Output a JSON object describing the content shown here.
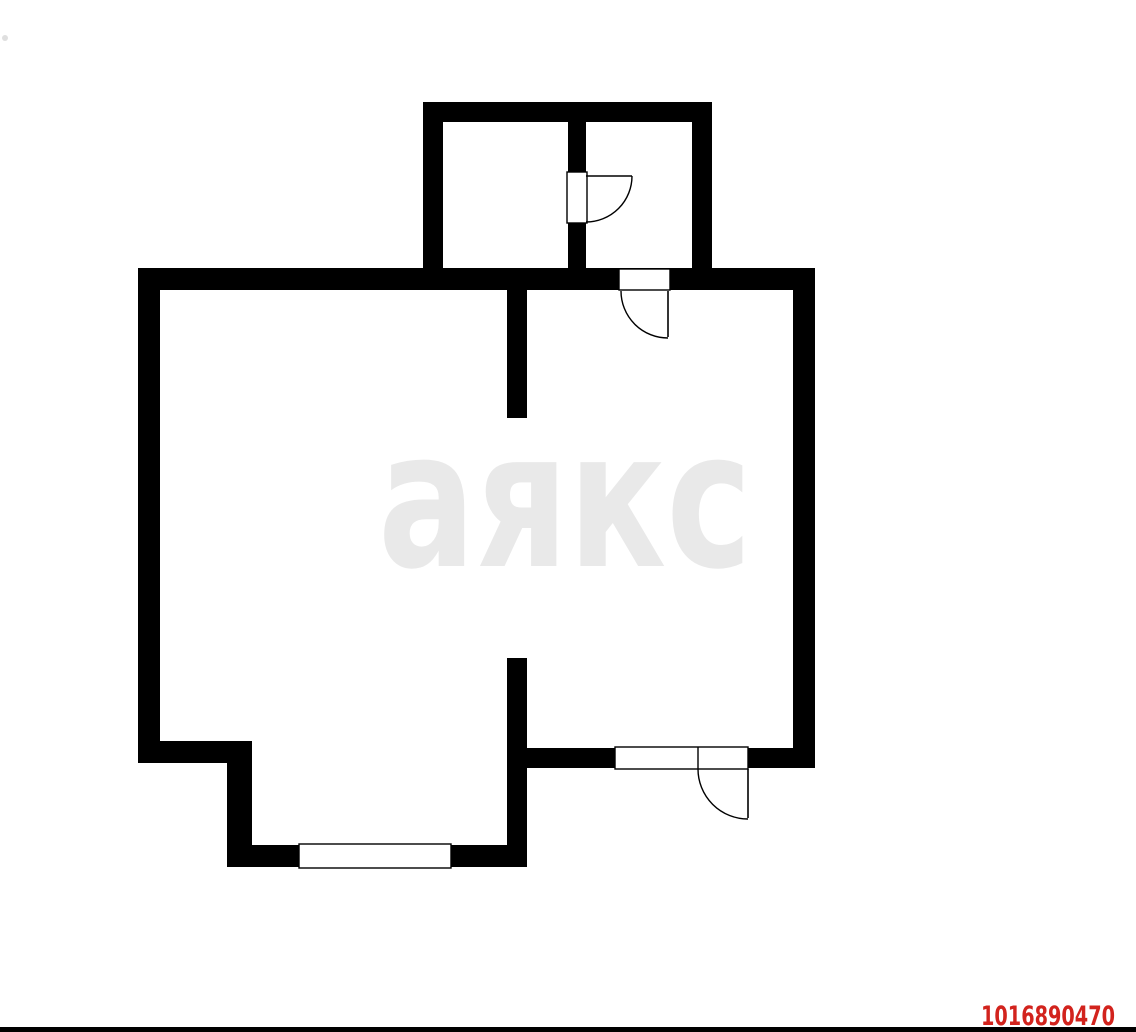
{
  "watermark": {
    "text": "аякс",
    "color": "#e9e9e9"
  },
  "listing_id": {
    "text": "1016890470",
    "color": "#d2231d"
  },
  "bottom_bar": {
    "color": "#000000",
    "x": 0,
    "y": 1027,
    "w": 1136,
    "h": 5
  },
  "artifact": {
    "color": "#c9c9c9"
  },
  "plan": {
    "canvas": {
      "width": 1136,
      "height": 1032
    },
    "wall_color": "#000000",
    "outline_width": 1.4,
    "walls": [
      {
        "name": "upper-top",
        "x": 423,
        "y": 102,
        "w": 289,
        "h": 20
      },
      {
        "name": "upper-left",
        "x": 423,
        "y": 102,
        "w": 20,
        "h": 168
      },
      {
        "name": "upper-right",
        "x": 692,
        "y": 102,
        "w": 20,
        "h": 168
      },
      {
        "name": "upper-partition",
        "x": 568,
        "y": 122,
        "w": 18,
        "h": 148
      },
      {
        "name": "main-top",
        "x": 138,
        "y": 268,
        "w": 677,
        "h": 22
      },
      {
        "name": "main-left",
        "x": 138,
        "y": 268,
        "w": 22,
        "h": 495
      },
      {
        "name": "main-right",
        "x": 793,
        "y": 268,
        "w": 22,
        "h": 500
      },
      {
        "name": "stub-upper",
        "x": 507,
        "y": 290,
        "w": 20,
        "h": 128
      },
      {
        "name": "stub-lower",
        "x": 507,
        "y": 658,
        "w": 20,
        "h": 209
      },
      {
        "name": "main-bottom-right",
        "x": 507,
        "y": 748,
        "w": 308,
        "h": 20
      },
      {
        "name": "step-top",
        "x": 138,
        "y": 741,
        "w": 114,
        "h": 22
      },
      {
        "name": "step-side",
        "x": 227,
        "y": 741,
        "w": 25,
        "h": 126
      },
      {
        "name": "balcony-bottom",
        "x": 227,
        "y": 845,
        "w": 300,
        "h": 22
      }
    ],
    "openings": [
      {
        "name": "upper-door-opening",
        "x": 567,
        "y": 172,
        "w": 20,
        "h": 51
      },
      {
        "name": "top-door-opening",
        "x": 619,
        "y": 269,
        "w": 51,
        "h": 21
      },
      {
        "name": "bottom-door-opening",
        "x": 615,
        "y": 747,
        "w": 133,
        "h": 22,
        "divider_x": 698
      },
      {
        "name": "balcony-window",
        "x": 299,
        "y": 844,
        "w": 152,
        "h": 24
      }
    ],
    "doors": [
      {
        "name": "upper-door",
        "leaf": [
          586,
          176,
          632,
          176
        ],
        "arc": "M 632 176 A 46 46 0 0 1 586 222"
      },
      {
        "name": "top-door",
        "leaf": [
          668,
          291,
          668,
          337
        ],
        "arc": "M 621 291 A 47 47 0 0 0 668 338"
      },
      {
        "name": "bottom-door",
        "leaf": [
          748,
          769,
          748,
          818
        ],
        "arc": "M 698 769 A 50 50 0 0 0 748 819"
      }
    ]
  }
}
